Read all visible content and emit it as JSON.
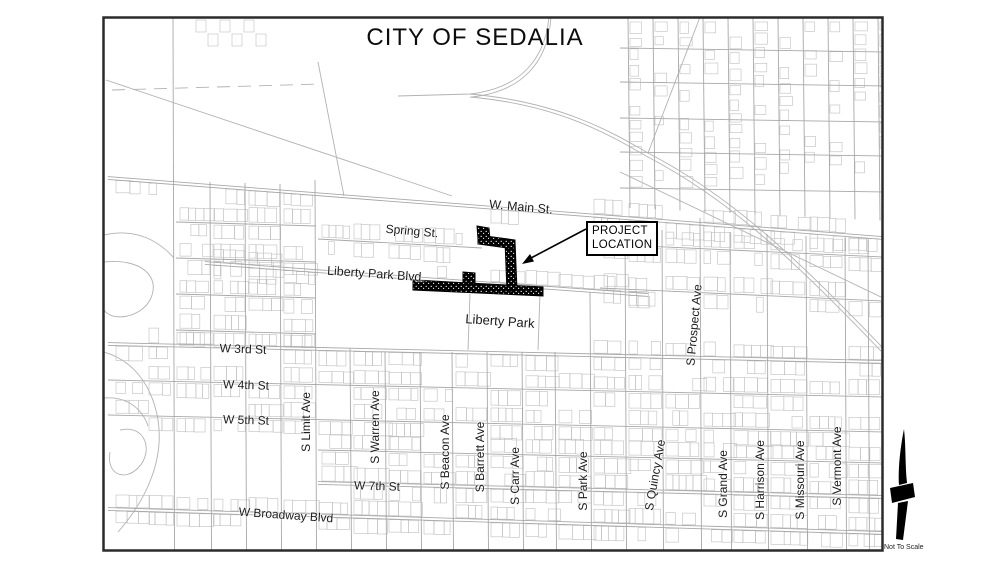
{
  "title": "CITY OF SEDALIA",
  "map": {
    "streets": {
      "horizontal": [
        {
          "name": "W. Main St."
        },
        {
          "name": "Spring St."
        },
        {
          "name": "Liberty Park Blvd."
        },
        {
          "name": "W 3rd St"
        },
        {
          "name": "W 4th St"
        },
        {
          "name": "W 5th St"
        },
        {
          "name": "W 7th St"
        },
        {
          "name": "W Broadway Blvd"
        }
      ],
      "vertical": [
        {
          "name": "S Limit Ave"
        },
        {
          "name": "S Warren Ave"
        },
        {
          "name": "S Beacon Ave"
        },
        {
          "name": "S Barrett Ave"
        },
        {
          "name": "S Carr Ave"
        },
        {
          "name": "S Park Ave"
        },
        {
          "name": "S Quincy Ave"
        },
        {
          "name": "S Prospect Ave"
        },
        {
          "name": "S Grand Ave"
        },
        {
          "name": "S Harrison Ave"
        },
        {
          "name": "S Missouri Ave"
        },
        {
          "name": "S Vermont Ave"
        }
      ]
    },
    "areas": {
      "park": "Liberty Park"
    },
    "callout": {
      "text": "PROJECT\nLOCATION"
    },
    "north_arrow_note": "Not To Scale"
  },
  "colors": {
    "background": "#ffffff",
    "border": "#2b2b2b",
    "street_line": "#a8a8a8",
    "parcel_line": "#bfbfbf",
    "deco_line": "#b2b2b2",
    "label": "#1b1b1b",
    "project_fill": "#000000"
  }
}
